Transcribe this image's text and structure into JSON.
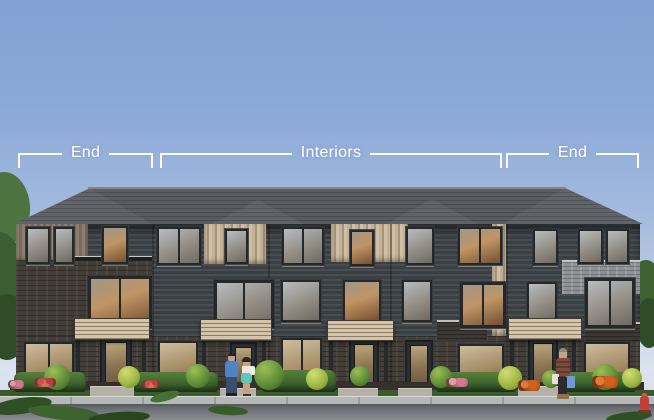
{
  "annotations": {
    "brackets": [
      {
        "label": "End"
      },
      {
        "label": "Interiors"
      },
      {
        "label": "End"
      }
    ],
    "line_color": "#ffffff"
  },
  "scene": {
    "type": "architectural rendering",
    "subject": "three-storey townhome block, street elevation",
    "unit_sections": [
      "End",
      "Interiors",
      "End"
    ],
    "end_unit_count": 2,
    "interior_unit_count": 3,
    "entry_door_count": 5,
    "features": [
      "hip roof",
      "dark horizontal siding",
      "vertical accent panels",
      "brick base",
      "slatted entry canopies",
      "front hedges and shrubs",
      "couple at entry",
      "pedestrian with shopping bags",
      "sidewalk",
      "street",
      "fire hydrant"
    ]
  },
  "colors": {
    "sky_top": "#82a1d4",
    "sky_horizon": "#dbe3f0",
    "annotation_line": "#ffffff",
    "roof_shingle": "#56595e",
    "siding": "#40454a",
    "accent_panel": "#bcab92",
    "brick_dark": "#433d37",
    "brick_light": "#8f9195",
    "canopy": "#c9b99e",
    "hedge": "#3f6a2e",
    "sidewalk": "#b5b7b9",
    "road": "#77797c"
  }
}
